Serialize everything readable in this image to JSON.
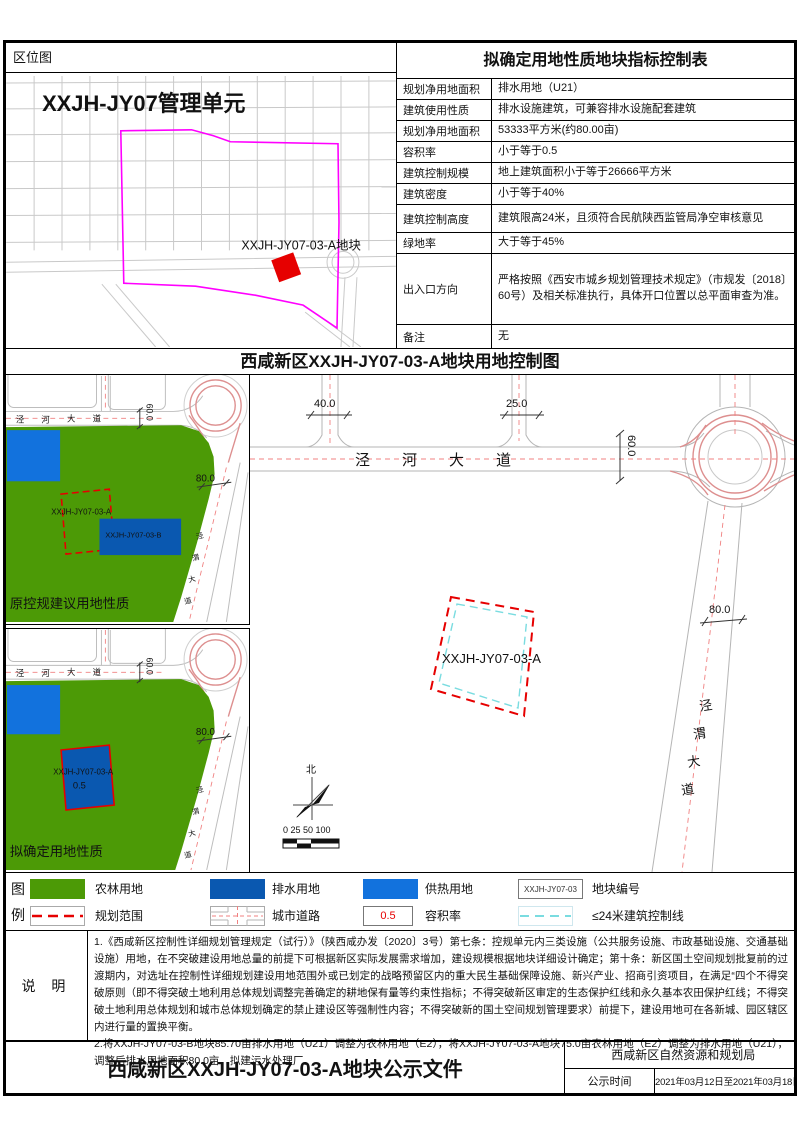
{
  "location_panel": {
    "header": "区位图",
    "unit_title": "XXJH-JY07管理单元",
    "parcel_label": "XXJH-JY07-03-A地块"
  },
  "indicator_table": {
    "title": "拟确定用地性质地块指标控制表",
    "rows": [
      {
        "label": "规划净用地面积",
        "value": "排水用地（U21）"
      },
      {
        "label": "建筑使用性质",
        "value": "排水设施建筑，可兼容排水设施配套建筑"
      },
      {
        "label": "规划净用地面积",
        "value": "53333平方米(约80.00亩)"
      },
      {
        "label": "容积率",
        "value": "小于等于0.5"
      },
      {
        "label": "建筑控制规模",
        "value": "地上建筑面积小于等于26666平方米"
      },
      {
        "label": "建筑密度",
        "value": "小于等于40%"
      },
      {
        "label": "建筑控制高度",
        "value": "建筑限高24米，且须符合民航陕西监管局净空审核意见"
      },
      {
        "label": "绿地率",
        "value": "大于等于45%"
      },
      {
        "label": "出入口方向",
        "value": "严格按照《西安市城乡规划管理技术规定》（市规发〔2018〕60号）及相关标准执行，具体开口位置以总平面审查为准。"
      },
      {
        "label": "备注",
        "value": "无"
      }
    ]
  },
  "control_map": {
    "title": "西咸新区XXJH-JY07-03-A地块用地控制图",
    "parcel_label": "XXJH-JY07-03-A",
    "north_label": "北",
    "scale_label": "0 25 50  100"
  },
  "roads": {
    "jinghe": [
      "泾",
      "河",
      "大",
      "道"
    ],
    "jingwei": [
      "泾",
      "渭",
      "大",
      "道"
    ]
  },
  "dims": {
    "w40": "40.0",
    "w25": "25.0",
    "w60": "60.0",
    "w80": "80.0"
  },
  "map_original": {
    "caption": "原控规建议用地性质",
    "parcel_a": "XXJH-JY07-03-A",
    "parcel_b": "XXJH-JY07-03-B"
  },
  "map_proposed": {
    "caption": "拟确定用地性质",
    "parcel_a": "XXJH-JY07-03-A",
    "far": "0.5"
  },
  "legend": {
    "col_chars": [
      "图",
      "例"
    ],
    "items": [
      {
        "label": "农林用地"
      },
      {
        "label": "排水用地"
      },
      {
        "label": "供热用地"
      },
      {
        "code": "XXJH-JY07-03",
        "label": "地块编号"
      },
      {
        "label": "规划范围"
      },
      {
        "label": "城市道路"
      },
      {
        "value": "0.5",
        "label": "容积率"
      },
      {
        "label": "≤24米建筑控制线"
      }
    ]
  },
  "notes": {
    "header": "说 明",
    "p1": "1.《西咸新区控制性详细规划管理规定（试行）》（陕西咸办发〔2020〕3号）第七条：控规单元内三类设施（公共服务设施、市政基础设施、交通基础设施）用地，在不突破建设用地总量的前提下可根据新区实际发展需求增加，建设规模根据地块详细设计确定；第十条：新区国土空间规划批复前的过渡期内，对选址在控制性详细规划建设用地范围外或已划定的战略预留区内的重大民生基础保障设施、新兴产业、招商引资项目，在满足“四个不得突破原则（即不得突破土地利用总体规划调整完善确定的耕地保有量等约束性指标；不得突破新区审定的生态保护红线和永久基本农田保护红线；不得突破土地利用总体规划和城市总体规划确定的禁止建设区等强制性内容；不得突破新的国土空间规划管理要求）前提下，建设用地可在各新城、园区辖区内进行量的置换平衡。",
    "p2": "2.将XXJH-JY07-03-B地块85.70亩排水用地（U21）调整为农林用地（E2），将XXJH-JY07-03-A地块75.0亩农林用地（E2）调整为排水用地（U21），调整后排水用地面积80.0亩，拟建污水处理厂。"
  },
  "footer": {
    "doc_title": "西咸新区XXJH-JY07-03-A地块公示文件",
    "agency": "西咸新区自然资源和规划局",
    "publish_label": "公示时间",
    "publish_value": "2021年03月12日至2021年03月18日"
  },
  "colors": {
    "farm_green": "#4C9A06",
    "drainage_blue": "#0A58B0",
    "heating_blue": "#1272DD",
    "plan_boundary_red": "#FF0000",
    "unit_boundary_magenta": "#FF00FF",
    "height_control_cyan": "#7ADCE0",
    "road_centerline_pink": "#F08080"
  }
}
